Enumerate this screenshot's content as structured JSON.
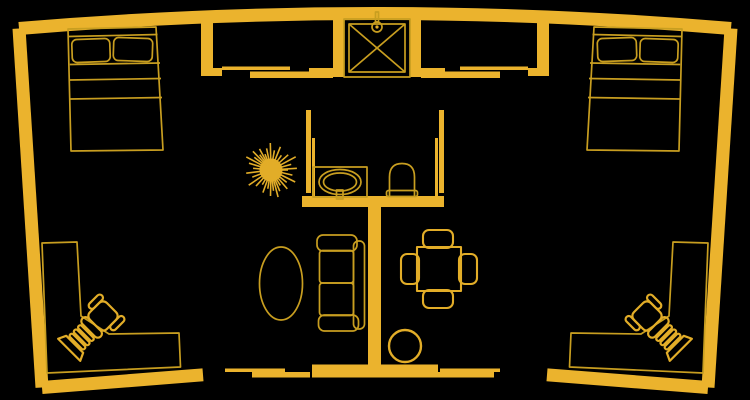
{
  "window": {
    "width": 750,
    "height": 400,
    "background": "#000000"
  },
  "colors": {
    "background": "#000000",
    "wall_fill": "#EBB32D",
    "furniture_line": "#C89E20",
    "fixture_line": "#E2AD28"
  },
  "floorplan": {
    "style": "top-down architectural line drawing, gold lines on black",
    "rooms": [
      {
        "name": "bedroom-left",
        "furniture": [
          "double-bed"
        ]
      },
      {
        "name": "bedroom-right",
        "furniture": [
          "double-bed"
        ]
      },
      {
        "name": "bathroom",
        "furniture": [
          "shower-stall",
          "vanity-sink",
          "toilet"
        ]
      },
      {
        "name": "living-area",
        "furniture": [
          "sofa",
          "oval-coffee-table",
          "potted-plant",
          "round-stool"
        ]
      },
      {
        "name": "dining-area",
        "furniture": [
          "square-dining-table",
          "dining-chair",
          "dining-chair",
          "dining-chair",
          "dining-chair"
        ]
      },
      {
        "name": "office-nook-left",
        "furniture": [
          "l-shaped-desk",
          "office-chair"
        ]
      },
      {
        "name": "office-nook-right",
        "furniture": [
          "l-shaped-desk",
          "office-chair"
        ]
      }
    ],
    "doors": [
      {
        "name": "sliding-door-top-left"
      },
      {
        "name": "sliding-door-top-right"
      },
      {
        "name": "sliding-door-bottom-left"
      },
      {
        "name": "sliding-door-bottom-right"
      },
      {
        "name": "pocket-door-bathroom-left"
      },
      {
        "name": "pocket-door-bathroom-right"
      }
    ]
  }
}
